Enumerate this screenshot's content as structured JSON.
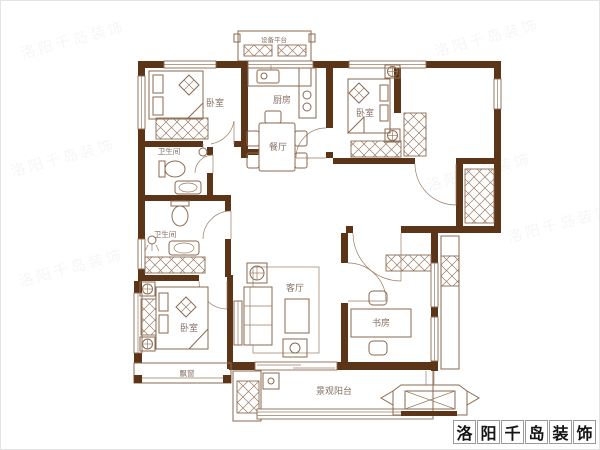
{
  "plan": {
    "type": "apartment-floor-plan",
    "rooms": {
      "bedroom_top_left": "卧室",
      "bedroom_top_right": "卧室",
      "bedroom_bottom_left": "卧室",
      "kitchen": "厨房",
      "dining": "餐厅",
      "bath_upper": "卫生间",
      "bath_lower": "卫生间",
      "living": "客厅",
      "study": "书房",
      "bay_window": "飘窗",
      "balcony": "景观阳台",
      "equipment_platform": "设备平台"
    },
    "colors": {
      "wall": "#5c3418",
      "furniture_line": "#8a6a52",
      "label_text": "#857065",
      "background": "#ffffff"
    }
  },
  "brand": {
    "name": "洛阳千岛装饰",
    "chars": [
      "洛",
      "阳",
      "千",
      "岛",
      "装",
      "饰"
    ]
  },
  "watermark": {
    "tile_text": "洛阳千岛装饰"
  }
}
